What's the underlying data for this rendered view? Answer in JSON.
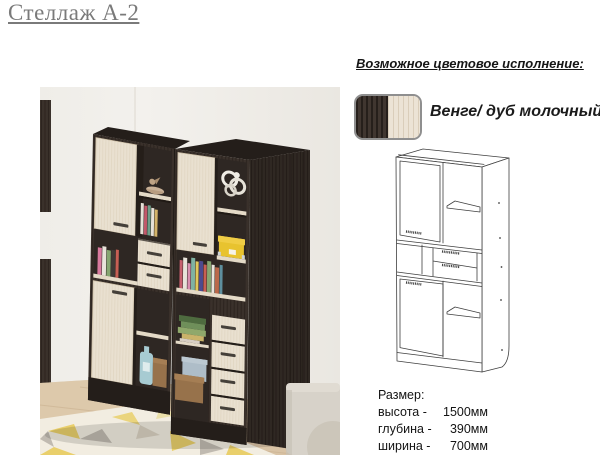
{
  "page": {
    "title": "Стеллаж А-2"
  },
  "color_options": {
    "heading": "Возможное цветовое исполнение:",
    "swatch_label": "Венге/ дуб молочный",
    "swatch": {
      "wenge_hex": "#3a3029",
      "milk_oak_hex": "#ece3d5"
    }
  },
  "dimensions": {
    "heading": "Размер:",
    "rows": [
      {
        "label": "высота -",
        "value": "1500мм"
      },
      {
        "label": "глубина -",
        "value": "390мм"
      },
      {
        "label": "ширина -",
        "value": "700мм"
      }
    ]
  },
  "colors": {
    "wenge": "#3a312b",
    "wenge_dark": "#241e1a",
    "interior": "#2e2723",
    "milk_oak": "#e9e0d0",
    "shelf_light": "#e4dac7",
    "handle": "#45403a",
    "wall": "#f2f0eb",
    "floor": "#d9c3a5",
    "rug_base": "#f2ede1",
    "rug_yellow": "#e9cf6b",
    "rug_gray": "#c0bab0",
    "sofa": "#d7d2c9",
    "box_yellow": "#e8c32f",
    "box_blue": "#aebdc8",
    "box_brown": "#97724b",
    "jug_blue": "#a7cbd2",
    "decor_beige": "#c9b197",
    "title_gray": "#7a7a7a",
    "text": "#161616",
    "drawing_stroke": "#3f3f3f",
    "swatch_border": "#8f8f8f"
  }
}
